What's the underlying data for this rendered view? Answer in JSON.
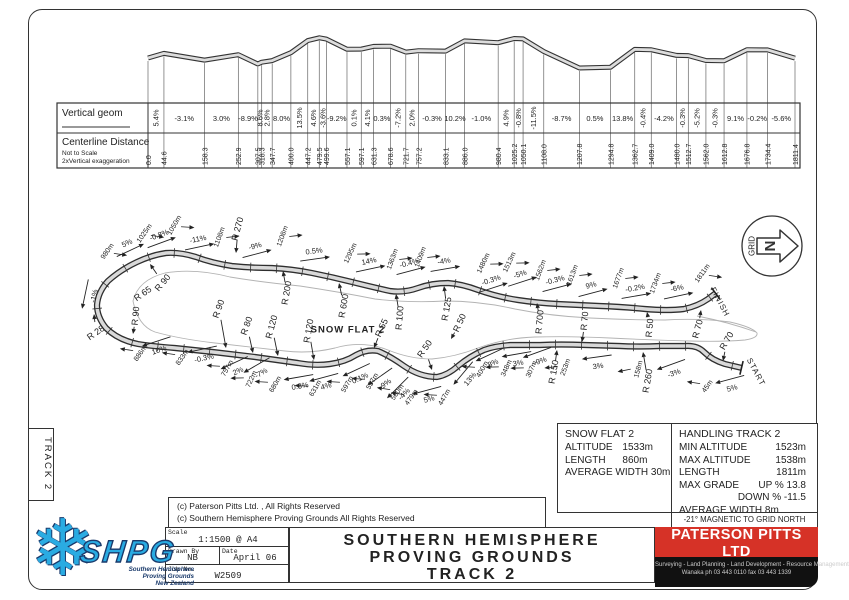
{
  "side_tab": "TRACK 2",
  "profile_table": {
    "row1_label": "Vertical geom",
    "row2_label": "Centerline Distance",
    "row2_note1": "Not to Scale",
    "row2_note2": "2xVertical exaggeration",
    "stations": [
      0.0,
      44.6,
      158.3,
      252.9,
      307.5,
      318.3,
      347.7,
      400.0,
      447.2,
      479.5,
      499.6,
      557.1,
      597.1,
      631.3,
      678.6,
      721.7,
      757.2,
      833.1,
      886.0,
      980.4,
      1025.2,
      1050.1,
      1108.0,
      1207.8,
      1294.8,
      1362.7,
      1409.0,
      1480.0,
      1512.7,
      1562.0,
      1612.8,
      1676.8,
      1734.4,
      1811.4
    ],
    "grades": [
      "5.4%",
      "-3.1%",
      "3.0%",
      "-8.9%",
      "8.6%",
      "2.8%",
      "8.0%",
      "13.5%",
      "4.6%",
      "-3.6%",
      "-9.2%",
      "0.1%",
      "4.1%",
      "0.3%",
      "-7.2%",
      "2.0%",
      "-0.3%",
      "10.2%",
      "-1.0%",
      "4.9%",
      "-0.8%",
      "-11.5%",
      "-8.7%",
      "0.5%",
      "13.8%",
      "-0.4%",
      "-4.2%",
      "-0.3%",
      "-5.2%",
      "-0.3%",
      "9.1%",
      "-0.2%",
      "-5.6%"
    ],
    "grade_vertical": [
      true,
      false,
      false,
      false,
      true,
      true,
      false,
      true,
      true,
      true,
      false,
      true,
      true,
      false,
      true,
      true,
      false,
      false,
      false,
      true,
      true,
      true,
      false,
      false,
      false,
      true,
      false,
      true,
      true,
      true,
      false,
      false,
      false
    ]
  },
  "chart_data": {
    "type": "line",
    "title": "Track 2 vertical geometry profile (2x vertical exaggeration)",
    "x": [
      0.0,
      44.6,
      158.3,
      252.9,
      307.5,
      318.3,
      347.7,
      400.0,
      447.2,
      479.5,
      499.6,
      557.1,
      597.1,
      631.3,
      678.6,
      721.7,
      757.2,
      833.1,
      886.0,
      980.4,
      1025.2,
      1050.1,
      1108.0,
      1207.8,
      1294.8,
      1362.7,
      1409.0,
      1480.0,
      1512.7,
      1562.0,
      1612.8,
      1676.8,
      1734.4,
      1811.4
    ],
    "series": [
      {
        "name": "grade_percent_between_stations",
        "values": [
          5.4,
          -3.1,
          3.0,
          -8.9,
          8.6,
          2.8,
          8.0,
          13.5,
          4.6,
          -3.6,
          -9.2,
          0.1,
          4.1,
          0.3,
          -7.2,
          2.0,
          -0.3,
          10.2,
          -1.0,
          4.9,
          -0.8,
          -11.5,
          -8.7,
          0.5,
          13.8,
          -0.4,
          -4.2,
          -0.3,
          -5.2,
          -0.3,
          9.1,
          -0.2,
          -5.6
        ]
      }
    ],
    "xlabel": "Centerline Distance (m)",
    "ylabel": "Vertical geom (%)"
  },
  "plan": {
    "track_path": "M742,368 L725,364 Q712,360 704,352 Q697,345 685,346 L660,346 Q640,347 620,346 L585,345 Q560,344 540,345 L510,345 Q495,346 484,350 Q470,356 458,366 Q448,375 437,377 Q420,377 404,366 Q390,356 378,351 Q367,349 356,355 Q345,362 330,364 Q315,366 298,363 L255,357 Q215,352 175,348 Q150,346 138,344 Q118,340 106,328 Q97,317 97,305 Q98,292 108,281 Q120,270 137,262 Q152,255 166,253 Q180,252 196,257 Q212,263 232,266 Q252,268 272,268 Q292,269 312,273 Q332,277 352,282 Q372,287 390,291 Q404,293 418,288 Q432,283 448,283 Q462,284 478,290 Q498,297 518,300 Q538,303 558,304 L600,306 Q625,307 645,309 Q668,311 684,309 Q698,306 708,299 L716,293",
    "flat_paths": [
      "M133,301 Q138,280 165,273 Q195,268 230,277 Q260,282 300,286 Q340,292 375,299 Q410,303 445,301 Q480,301 515,309 Q550,316 590,318 Q630,320 665,320 Q700,318 730,322 Q752,327 757,333 Q758,338 745,340 Q720,342 690,341 Q650,340 610,338 Q570,336 535,337 Q505,338 478,348 Q455,357 432,359 Q410,359 388,350 Q362,340 335,348 Q310,354 285,351 Q250,347 215,343 Q180,339 155,332 Q138,326 133,301 Z",
      "M697,316 Q728,322 756,332"
    ],
    "grid_arrow": {
      "label": "GRID",
      "letter": "N"
    },
    "labels": [
      {
        "t": "980m",
        "x": 107,
        "y": 251,
        "r": -55,
        "k": "sta",
        "s": "t"
      },
      {
        "t": "5%",
        "x": 127,
        "y": 243,
        "r": -25,
        "k": "g",
        "s": "t"
      },
      {
        "t": "1025m",
        "x": 144,
        "y": 233,
        "r": -55,
        "k": "sta",
        "s": "t"
      },
      {
        "t": "-0.8%",
        "x": 159,
        "y": 235,
        "r": -20,
        "k": "g",
        "s": "t"
      },
      {
        "t": "1050m",
        "x": 174,
        "y": 225,
        "r": -60,
        "k": "sta",
        "s": "t"
      },
      {
        "t": "-11%",
        "x": 198,
        "y": 239,
        "r": -12,
        "k": "g",
        "s": "t"
      },
      {
        "t": "1108m",
        "x": 219,
        "y": 237,
        "r": -70,
        "k": "sta",
        "s": "t"
      },
      {
        "t": "R 270",
        "x": 238,
        "y": 229,
        "r": -75,
        "k": "r",
        "a": [
          236,
          253
        ]
      },
      {
        "t": "-9%",
        "x": 255,
        "y": 246,
        "r": -15,
        "k": "g",
        "s": "t"
      },
      {
        "t": "1208m",
        "x": 282,
        "y": 236,
        "r": -70,
        "k": "sta",
        "s": "t"
      },
      {
        "t": "0.5%",
        "x": 314,
        "y": 251,
        "r": -8,
        "k": "g",
        "s": "t"
      },
      {
        "t": "1295m",
        "x": 350,
        "y": 253,
        "r": -65,
        "k": "sta",
        "s": "t"
      },
      {
        "t": "14%",
        "x": 369,
        "y": 261,
        "r": -12,
        "k": "g",
        "s": "t"
      },
      {
        "t": "1363m",
        "x": 392,
        "y": 259,
        "r": -70,
        "k": "sta",
        "s": "t"
      },
      {
        "t": "-0.4%",
        "x": 409,
        "y": 263,
        "r": -15,
        "k": "g",
        "s": "t"
      },
      {
        "t": "1409m",
        "x": 420,
        "y": 257,
        "r": -70,
        "k": "sta",
        "s": "t"
      },
      {
        "t": "-4%",
        "x": 444,
        "y": 261,
        "r": -10,
        "k": "g",
        "s": "t"
      },
      {
        "t": "1480m",
        "x": 483,
        "y": 263,
        "r": -65,
        "k": "sta",
        "s": "t"
      },
      {
        "t": "-0.3%",
        "x": 491,
        "y": 280,
        "r": -18,
        "k": "g",
        "s": "t"
      },
      {
        "t": "1513m",
        "x": 509,
        "y": 262,
        "r": -65,
        "k": "sta",
        "s": "t"
      },
      {
        "t": "-5%",
        "x": 520,
        "y": 274,
        "r": -18,
        "k": "g",
        "s": "t"
      },
      {
        "t": "1562m",
        "x": 540,
        "y": 270,
        "r": -70,
        "k": "sta",
        "s": "t"
      },
      {
        "t": "-0.3%",
        "x": 555,
        "y": 280,
        "r": -15,
        "k": "g",
        "s": "t"
      },
      {
        "t": "1613m",
        "x": 572,
        "y": 275,
        "r": -70,
        "k": "sta",
        "s": "t"
      },
      {
        "t": "9%",
        "x": 591,
        "y": 285,
        "r": -15,
        "k": "g",
        "s": "t"
      },
      {
        "t": "1677m",
        "x": 618,
        "y": 278,
        "r": -70,
        "k": "sta",
        "s": "t"
      },
      {
        "t": "-0.2%",
        "x": 635,
        "y": 288,
        "r": -10,
        "k": "g",
        "s": "t"
      },
      {
        "t": "1734m",
        "x": 655,
        "y": 283,
        "r": -70,
        "k": "sta",
        "s": "t"
      },
      {
        "t": "-6%",
        "x": 677,
        "y": 288,
        "r": -12,
        "k": "g",
        "s": "t"
      },
      {
        "t": "1811m",
        "x": 702,
        "y": 273,
        "r": -55,
        "k": "sta",
        "s": "t"
      },
      {
        "t": "FINISH",
        "x": 720,
        "y": 302,
        "r": 62,
        "k": "n"
      },
      {
        "t": "-1%",
        "x": 94,
        "y": 296,
        "r": -78,
        "k": "g",
        "s": "b"
      },
      {
        "t": "R 28",
        "x": 96,
        "y": 333,
        "r": -35,
        "k": "r",
        "a": [
          94,
          314
        ]
      },
      {
        "t": "886m",
        "x": 140,
        "y": 353,
        "r": -55,
        "k": "sta",
        "s": "b"
      },
      {
        "t": "10%",
        "x": 159,
        "y": 350,
        "r": -18,
        "k": "g",
        "s": "b"
      },
      {
        "t": "833m",
        "x": 182,
        "y": 357,
        "r": -55,
        "k": "sta",
        "s": "b"
      },
      {
        "t": "-0.3%",
        "x": 204,
        "y": 358,
        "r": -12,
        "k": "g",
        "s": "b"
      },
      {
        "t": "757m",
        "x": 227,
        "y": 368,
        "r": -60,
        "k": "sta",
        "s": "b"
      },
      {
        "t": "2%",
        "x": 238,
        "y": 371,
        "r": -25,
        "k": "g",
        "s": "b"
      },
      {
        "t": "722m",
        "x": 251,
        "y": 379,
        "r": -65,
        "k": "sta",
        "s": "b"
      },
      {
        "t": "-7%",
        "x": 261,
        "y": 373,
        "r": -30,
        "k": "g",
        "s": "b"
      },
      {
        "t": "680m",
        "x": 275,
        "y": 384,
        "r": -60,
        "k": "sta",
        "s": "b"
      },
      {
        "t": "0.3%",
        "x": 300,
        "y": 386,
        "r": -10,
        "k": "g",
        "s": "b"
      },
      {
        "t": "631m",
        "x": 315,
        "y": 388,
        "r": -60,
        "k": "sta",
        "s": "b"
      },
      {
        "t": "4%",
        "x": 326,
        "y": 386,
        "r": -15,
        "k": "g",
        "s": "b"
      },
      {
        "t": "597m",
        "x": 347,
        "y": 384,
        "r": -60,
        "k": "sta",
        "s": "b"
      },
      {
        "t": "0.1%",
        "x": 360,
        "y": 378,
        "r": -25,
        "k": "g",
        "s": "b"
      },
      {
        "t": "557m",
        "x": 372,
        "y": 381,
        "r": -60,
        "k": "sta",
        "s": "b"
      },
      {
        "t": "-9%",
        "x": 385,
        "y": 384,
        "r": -35,
        "k": "g",
        "s": "b"
      },
      {
        "t": "500m",
        "x": 397,
        "y": 392,
        "r": -55,
        "k": "sta",
        "s": "b"
      },
      {
        "t": "-4%",
        "x": 404,
        "y": 394,
        "r": -45,
        "k": "g",
        "s": "b"
      },
      {
        "t": "479m",
        "x": 411,
        "y": 397,
        "r": -55,
        "k": "sta",
        "s": "b"
      },
      {
        "t": "5%",
        "x": 429,
        "y": 399,
        "r": -15,
        "k": "g",
        "s": "b"
      },
      {
        "t": "447m",
        "x": 444,
        "y": 397,
        "r": -60,
        "k": "sta",
        "s": "b"
      },
      {
        "t": "13%",
        "x": 470,
        "y": 379,
        "r": -50,
        "k": "g",
        "s": "b"
      },
      {
        "t": "400m",
        "x": 482,
        "y": 369,
        "r": -60,
        "k": "sta",
        "s": "b"
      },
      {
        "t": "8%",
        "x": 493,
        "y": 363,
        "r": -25,
        "k": "g",
        "s": "b"
      },
      {
        "t": "348m",
        "x": 506,
        "y": 368,
        "r": -65,
        "k": "sta",
        "s": "b"
      },
      {
        "t": "3%",
        "x": 518,
        "y": 363,
        "r": -10,
        "k": "g",
        "s": "b"
      },
      {
        "t": "307m",
        "x": 531,
        "y": 369,
        "r": -65,
        "k": "sta",
        "s": "b"
      },
      {
        "t": "-9%",
        "x": 540,
        "y": 361,
        "r": -20,
        "k": "g",
        "s": "b"
      },
      {
        "t": "R 150",
        "x": 554,
        "y": 372,
        "r": -80,
        "k": "r",
        "a": [
          557,
          350
        ]
      },
      {
        "t": "253m",
        "x": 565,
        "y": 367,
        "r": -70,
        "k": "sta",
        "s": "b"
      },
      {
        "t": "3%",
        "x": 598,
        "y": 366,
        "r": -8,
        "k": "g",
        "s": "b"
      },
      {
        "t": "158m",
        "x": 638,
        "y": 369,
        "r": -75,
        "k": "sta",
        "s": "b"
      },
      {
        "t": "R 260",
        "x": 648,
        "y": 381,
        "r": -80,
        "k": "r",
        "a": [
          643,
          352
        ]
      },
      {
        "t": "-3%",
        "x": 674,
        "y": 373,
        "r": -20,
        "k": "g",
        "s": "b"
      },
      {
        "t": "45m",
        "x": 707,
        "y": 386,
        "r": -55,
        "k": "sta",
        "s": "b"
      },
      {
        "t": "5%",
        "x": 732,
        "y": 388,
        "r": -15,
        "k": "g",
        "s": "b"
      },
      {
        "t": "START",
        "x": 756,
        "y": 372,
        "r": 62,
        "k": "n"
      },
      {
        "t": "R 90",
        "x": 163,
        "y": 283,
        "r": -50,
        "k": "r",
        "a": [
          150,
          264
        ]
      },
      {
        "t": "R 65",
        "x": 143,
        "y": 294,
        "r": -35,
        "k": "r"
      },
      {
        "t": "R 90",
        "x": 136,
        "y": 316,
        "r": -85,
        "k": "r",
        "a": [
          133,
          334
        ]
      },
      {
        "t": "R 90",
        "x": 219,
        "y": 309,
        "r": -70,
        "k": "r",
        "a": [
          226,
          348
        ]
      },
      {
        "t": "R 80",
        "x": 247,
        "y": 326,
        "r": -70,
        "k": "r",
        "a": [
          253,
          353
        ]
      },
      {
        "t": "R 120",
        "x": 272,
        "y": 327,
        "r": -75,
        "k": "r",
        "a": [
          278,
          356
        ]
      },
      {
        "t": "R 200",
        "x": 287,
        "y": 293,
        "r": -80,
        "k": "r",
        "a": [
          283,
          271
        ]
      },
      {
        "t": "R 120",
        "x": 309,
        "y": 331,
        "r": -80,
        "k": "r",
        "a": [
          314,
          360
        ]
      },
      {
        "t": "R 600",
        "x": 344,
        "y": 306,
        "r": -80,
        "k": "r",
        "a": [
          339,
          283
        ]
      },
      {
        "t": "R 55",
        "x": 382,
        "y": 328,
        "r": -65,
        "k": "r",
        "a": [
          374,
          348
        ]
      },
      {
        "t": "R 100",
        "x": 400,
        "y": 318,
        "r": -85,
        "k": "r",
        "a": [
          396,
          294
        ]
      },
      {
        "t": "R 125",
        "x": 447,
        "y": 309,
        "r": -80,
        "k": "r",
        "a": [
          444,
          286
        ]
      },
      {
        "t": "R 50",
        "x": 460,
        "y": 323,
        "r": -65,
        "k": "r",
        "a": [
          451,
          339
        ]
      },
      {
        "t": "R 50",
        "x": 425,
        "y": 349,
        "r": -55,
        "k": "r",
        "a": [
          432,
          370
        ]
      },
      {
        "t": "R 700",
        "x": 540,
        "y": 322,
        "r": -85,
        "k": "r",
        "a": [
          537,
          303
        ]
      },
      {
        "t": "R 70",
        "x": 585,
        "y": 321,
        "r": -85,
        "k": "r",
        "a": [
          582,
          342
        ]
      },
      {
        "t": "R 50",
        "x": 650,
        "y": 328,
        "r": -85,
        "k": "r",
        "a": [
          647,
          312
        ]
      },
      {
        "t": "R 70",
        "x": 698,
        "y": 329,
        "r": -75,
        "k": "r",
        "a": [
          701,
          310
        ]
      },
      {
        "t": "R 70",
        "x": 727,
        "y": 341,
        "r": -60,
        "k": "r",
        "a": [
          723,
          361
        ]
      },
      {
        "t": "SNOW FLAT 2",
        "x": 348,
        "y": 330,
        "r": 0,
        "k": "n"
      }
    ]
  },
  "info_snow": {
    "title": "SNOW FLAT 2",
    "rows": [
      [
        "ALTITUDE",
        "1533m"
      ],
      [
        "LENGTH",
        "860m"
      ],
      [
        "AVERAGE WIDTH 30m",
        ""
      ]
    ]
  },
  "info_handling": {
    "title": "HANDLING TRACK 2",
    "rows": [
      [
        "MIN ALTITUDE",
        "1523m"
      ],
      [
        "MAX ALTITUDE",
        "1538m"
      ],
      [
        "LENGTH",
        "1811m"
      ],
      [
        "MAX GRADE",
        "UP % 13.8"
      ],
      [
        "",
        "DOWN % -11.5"
      ],
      [
        "AVERAGE WIDTH 8m",
        ""
      ]
    ]
  },
  "magnetic_note": "-21°  MAGNETIC TO GRID NORTH",
  "copyright": [
    "(c) Paterson Pitts Ltd. , All Rights Reserved",
    "(c) Southern Hemisphere Proving Grounds All Rights Reserved"
  ],
  "title_block": {
    "scale_label": "Scale",
    "scale": "1:1500 @ A4",
    "drawn_label": "Drawn By",
    "drawn": "NB",
    "date_label": "Date",
    "date": "April 06",
    "job_label": "Job No.",
    "job": "W2509",
    "title_lines": [
      "SOUTHERN  HEMISPHERE",
      "PROVING  GROUNDS",
      "TRACK  2"
    ]
  },
  "ppl": {
    "name": "PATERSON PITTS LTD",
    "towns": "Wanaka Cromwell Queenstown Alexandra Dunedin",
    "services": "Surveying - Land Planning - Land Development - Resource Management",
    "contact": "Wanaka    ph 03 443 0110    fax 03 443 1339",
    "red": "#d63227"
  },
  "logo": {
    "text": "SHPG",
    "snowflake": "❄",
    "sub": [
      "Southern Hemisphere",
      "Proving Grounds",
      "New Zealand"
    ],
    "blue": "#29abe2"
  }
}
